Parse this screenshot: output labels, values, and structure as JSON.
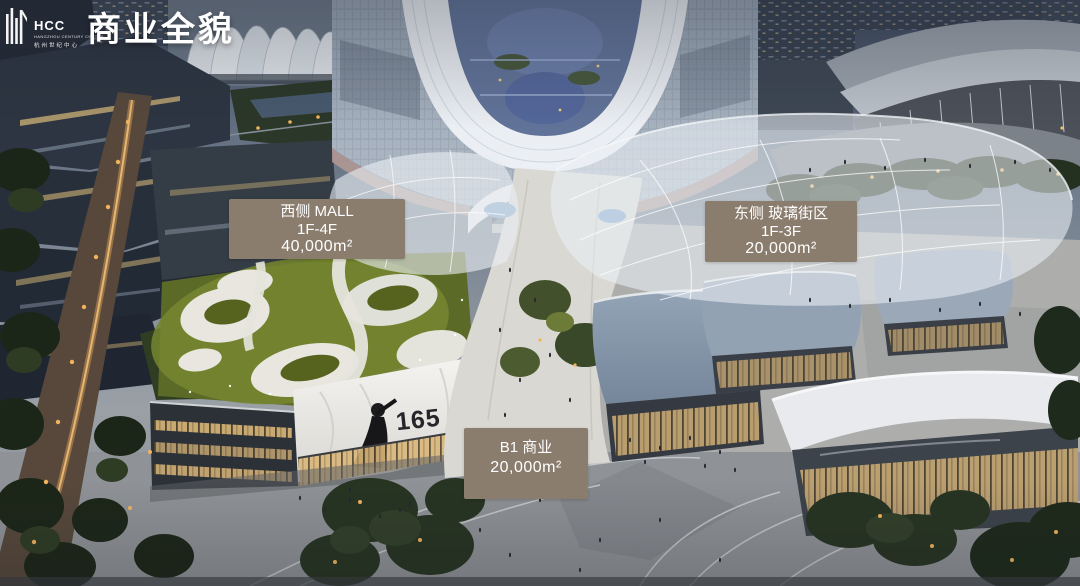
{
  "slide": {
    "title": "商业全貌",
    "logo": {
      "abbr": "HCC",
      "name_en": "HANGZHOU CENTURY CENTER",
      "name_cn": "杭州世纪中心"
    },
    "labels": {
      "west_mall": {
        "name": "西侧 MALL",
        "floors": "1F-4F",
        "area": "40,000m²"
      },
      "east_glass_street": {
        "name": "东侧 玻璃街区",
        "floors": "1F-3F",
        "area": "20,000m²"
      },
      "b1_commercial": {
        "name": "B1 商业",
        "area": "20,000m²"
      }
    },
    "billboard": {
      "text": "165"
    },
    "colors": {
      "label_bg": "#8a7d6e",
      "label_text": "#ffffff",
      "title_text": "#ffffff"
    }
  }
}
